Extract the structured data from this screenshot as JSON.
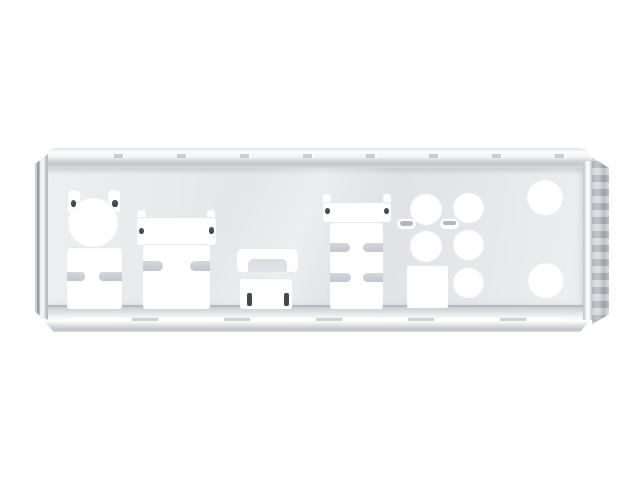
{
  "photo": {
    "subject": "Motherboard rear I/O shield plate",
    "alt": "Polished chrome-finish steel motherboard I/O shield with punched port cutouts, photographed on a plain white background",
    "background_color": "#ffffff",
    "material": "polished chrome / stainless steel"
  },
  "colors": {
    "plate_face": "#e3e5e8",
    "flange_highlight": "#ffffff",
    "edge_shadow": "#9ba0a5",
    "hole": "#ffffff",
    "metal_finger_bar": "#c6cace",
    "dimple_dark": "#43484d"
  },
  "cutouts": {
    "ps2": {
      "label": "PS/2 combo port cutout (round hole with two retention tabs)"
    },
    "usb_stack_left": {
      "label": "Dual stacked USB port cutout with EMI finger slots"
    },
    "lan_usb_left": {
      "label": "LAN-over-USB combo port cutout with corner tabs and side EMI slots"
    },
    "hdmi": {
      "label": "HDMI port cutout with spring-clip bridge above"
    },
    "lan_usb_right": {
      "label": "LAN-over-dual-USB combo port cutout with two rows of EMI slots"
    },
    "audio_jacks": {
      "label": "Round audio jack cutout",
      "count": 5
    },
    "emi_slots": {
      "label": "Small oval EMI spring slot",
      "count": 2
    },
    "spdif": {
      "label": "Square optical S/PDIF cutout"
    },
    "antenna_holes": {
      "label": "Large round antenna / vent hole",
      "count": 2
    }
  },
  "frame": {
    "top_flange": "folded top flange with stamped dimples",
    "bottom_flange": "folded bottom flange with bright lip segments",
    "left_edge": "folded left side wall",
    "right_edge": "folded right side wall"
  }
}
